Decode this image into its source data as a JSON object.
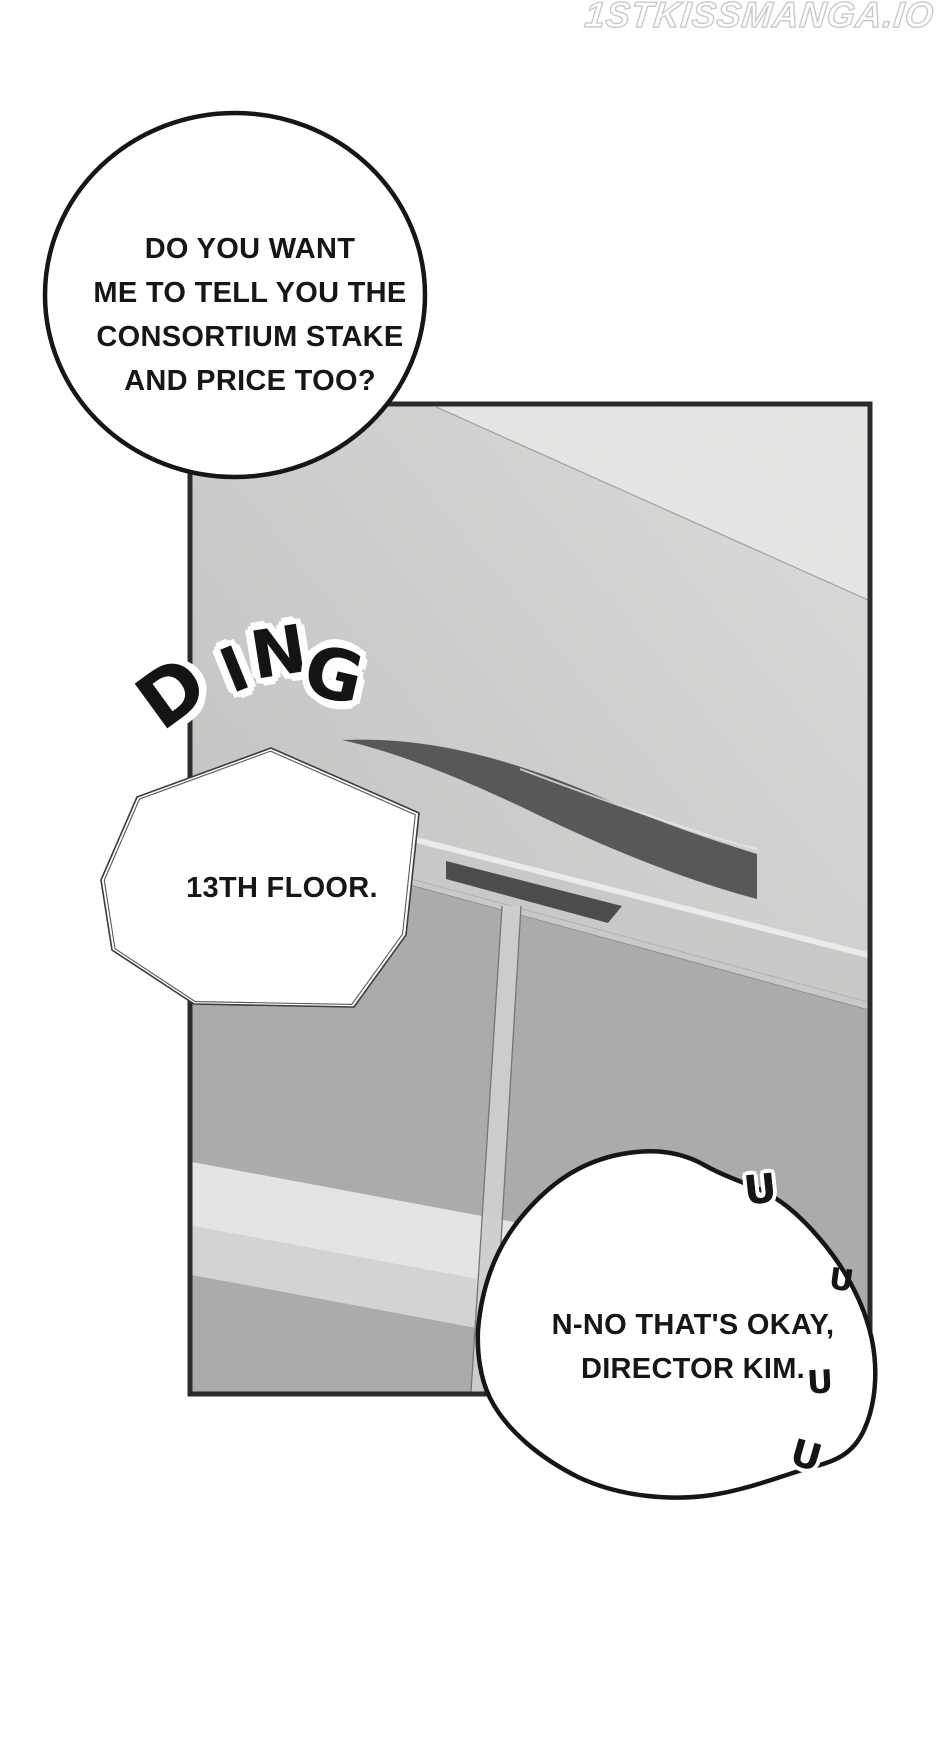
{
  "watermark": {
    "text": "1STKISSMANGA.IO"
  },
  "speech": {
    "question_bubble": {
      "lines": [
        "DO YOU WANT",
        "ME TO TELL YOU THE",
        "CONSORTIUM STAKE",
        "AND PRICE TOO?"
      ]
    },
    "floor_bubble": {
      "text": "13TH FLOOR."
    },
    "reply_bubble": {
      "lines": [
        "N-NO THAT'S OKAY,",
        "DIRECTOR KIM."
      ]
    }
  },
  "sfx": {
    "ding_letters": [
      "D",
      "I",
      "N",
      "G"
    ],
    "tremble_mark": "U"
  },
  "colors": {
    "page_bg": "#ffffff",
    "ink": "#161616",
    "panel_border": "#2b2b2b",
    "ceiling_dark": "#c3c5c2",
    "ceiling_light": "#dbddda",
    "ceiling_corner": "#e7e8e5",
    "arch_band": "#575757",
    "lintel": "#c9cbc8",
    "lintel_highlight": "#edeeeb",
    "indicator_slot": "#4b4b4b",
    "doors": "#abadaa",
    "stripe_bright": "#e6e7e4",
    "stripe_mid": "#d5d6d3",
    "door_seam": "#cfd1ce",
    "watermark_outline": "#c9c9c9"
  }
}
